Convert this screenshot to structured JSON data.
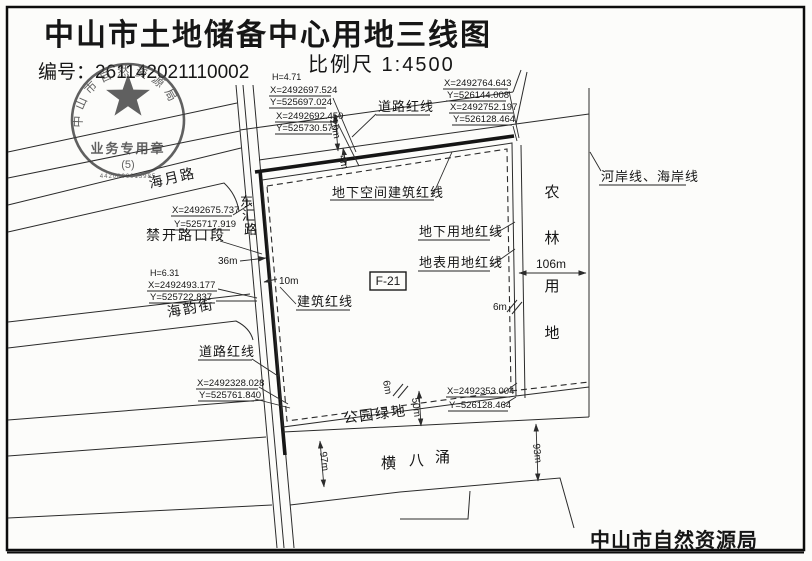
{
  "doc": {
    "title": "中山市土地储备中心用地三线图",
    "serial": "编号：261142021110002",
    "scale": "比例尺 1:4500",
    "agency": "中山市自然资源局"
  },
  "stamp": {
    "arc": "中山市自然资源局",
    "center": "业务专用章",
    "num": "(5)",
    "code": "4420800013985"
  },
  "roads": {
    "haiyue": "海月路",
    "donghui": [
      "东",
      "汇",
      "路"
    ],
    "haiyun": "海韵街",
    "canal": [
      "横",
      "八",
      "涌"
    ]
  },
  "areas": {
    "parcel": "F-21",
    "park": "公园绿地",
    "agri": [
      "农",
      "林",
      "用",
      "地"
    ]
  },
  "lines": {
    "road_top": "道路红线",
    "road_bottom": "道路红线",
    "building": "建筑红线",
    "ug_space": "地下空间建筑红线",
    "ug_land": "地下用地红线",
    "surface_land": "地表用地红线",
    "river": "河岸线、海岸线",
    "no_open": "禁开路口段"
  },
  "dims": {
    "d20": "20m",
    "d4": "4m",
    "d36": "36m",
    "d10": "10m",
    "d106": "106m",
    "d6a": "6m",
    "d6b": "6m",
    "d50": "50m",
    "d97": "97m",
    "d93": "93m"
  },
  "coords": {
    "h1": "H=4.71",
    "p1x": "X=2492697.524",
    "p1y": "Y=525697.024",
    "p2x": "X=2492692.450",
    "p2y": "Y=525730.574",
    "p3x": "X=2492764.643",
    "p3y": "Y=526144.008",
    "p4x": "X=2492752.197",
    "p4y": "Y=526128.464",
    "p5x": "X=2492675.737",
    "p5y": "Y=525717.919",
    "h2": "H=6.31",
    "p6x": "X=2492493.177",
    "p6y": "Y=525722.837",
    "p7x": "X=2492328.028",
    "p7y": "Y=525761.840",
    "p8x": "X=2492353.004",
    "p8y": "Y=526128.464"
  }
}
